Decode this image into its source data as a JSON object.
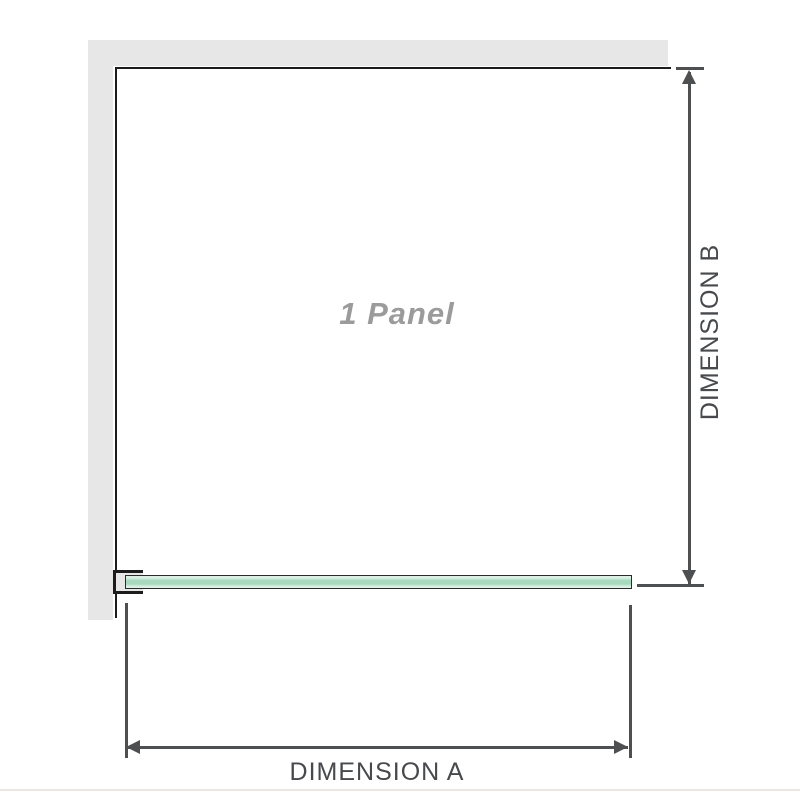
{
  "diagram": {
    "panel_label": "1 Panel",
    "dimension_a": {
      "label": "DIMENSION A"
    },
    "dimension_b": {
      "label": "DIMENSION B"
    }
  },
  "icons": {
    "arrow_up_icon": "css-triangle-up",
    "arrow_down_icon": "css-triangle-down",
    "arrow_left_icon": "css-triangle-left",
    "arrow_right_icon": "css-triangle-right"
  },
  "colors": {
    "background": "#ffffff",
    "wall": "#e7e7e7",
    "panel_border": "#1c1c1c",
    "dimension_line": "#4d4f50",
    "dimension_text": "#47494c",
    "panel_label": "#9b9b9b",
    "glass_border": "#2b2b2b",
    "glass_light": "#ddf0e6",
    "glass_mid": "#a6d9bd",
    "divider": "#eae6e0"
  }
}
